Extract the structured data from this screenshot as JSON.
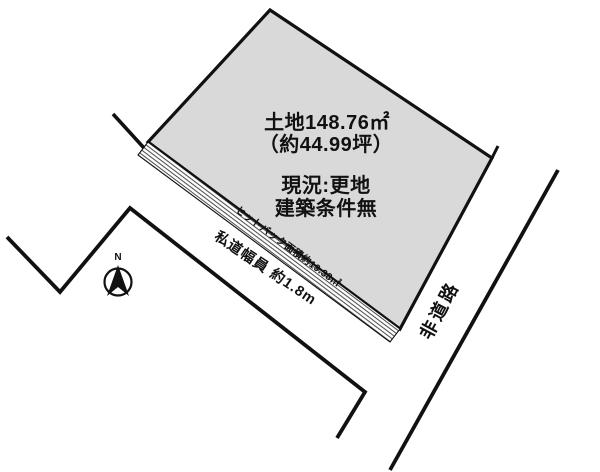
{
  "colors": {
    "parcel_fill": "#d9d9d9",
    "line": "#111111",
    "text": "#111111"
  },
  "parcel": {
    "area_label": "土地148.76㎡",
    "area_tsubo_label": "（約44.99坪）",
    "status_label": "現況:更地",
    "condition_label": "建築条件無"
  },
  "setback": {
    "label": "セットバック面積約19.38㎡"
  },
  "private_road": {
    "label": "私道幅員 約1.8m"
  },
  "adjacent_road": {
    "label": "非道路"
  },
  "compass": {
    "north_label": "N"
  }
}
